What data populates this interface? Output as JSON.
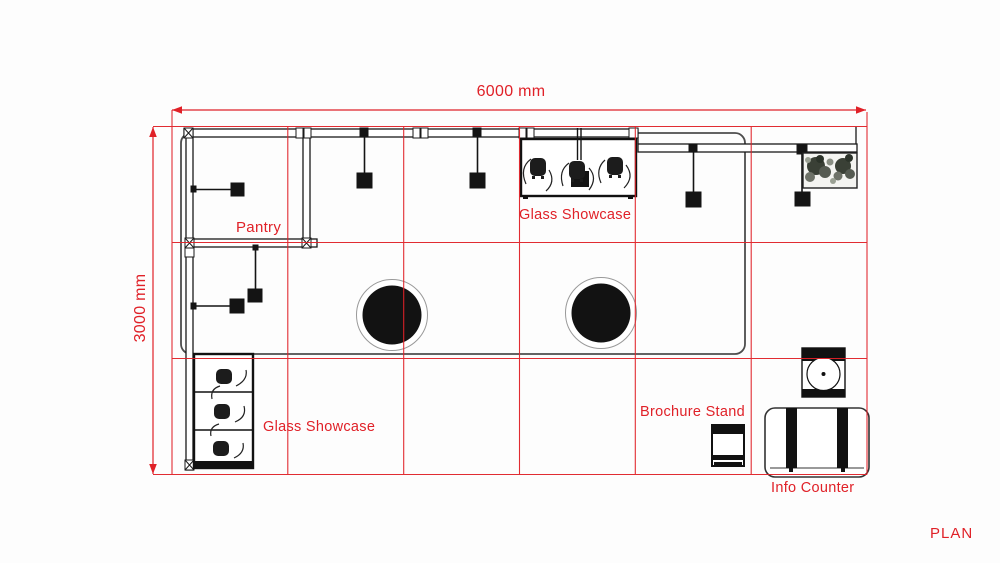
{
  "sheet": {
    "name": "PLAN"
  },
  "dimensions": {
    "width_label": "6000 mm",
    "height_label": "3000 mm",
    "width_mm": 6000,
    "height_mm": 3000
  },
  "annotations": {
    "pantry": "Pantry",
    "glass_showcase_top": "Glass Showcase",
    "glass_showcase_left": "Glass Showcase",
    "brochure_stand": "Brochure Stand",
    "info_counter": "Info Counter"
  },
  "grid": {
    "columns": 6,
    "rows": 3
  },
  "colors": {
    "annotation_red": "#E02128",
    "drawing_ink": "#141414",
    "platform_gray": "#4D4D4D",
    "background": "#FDFDFD"
  }
}
